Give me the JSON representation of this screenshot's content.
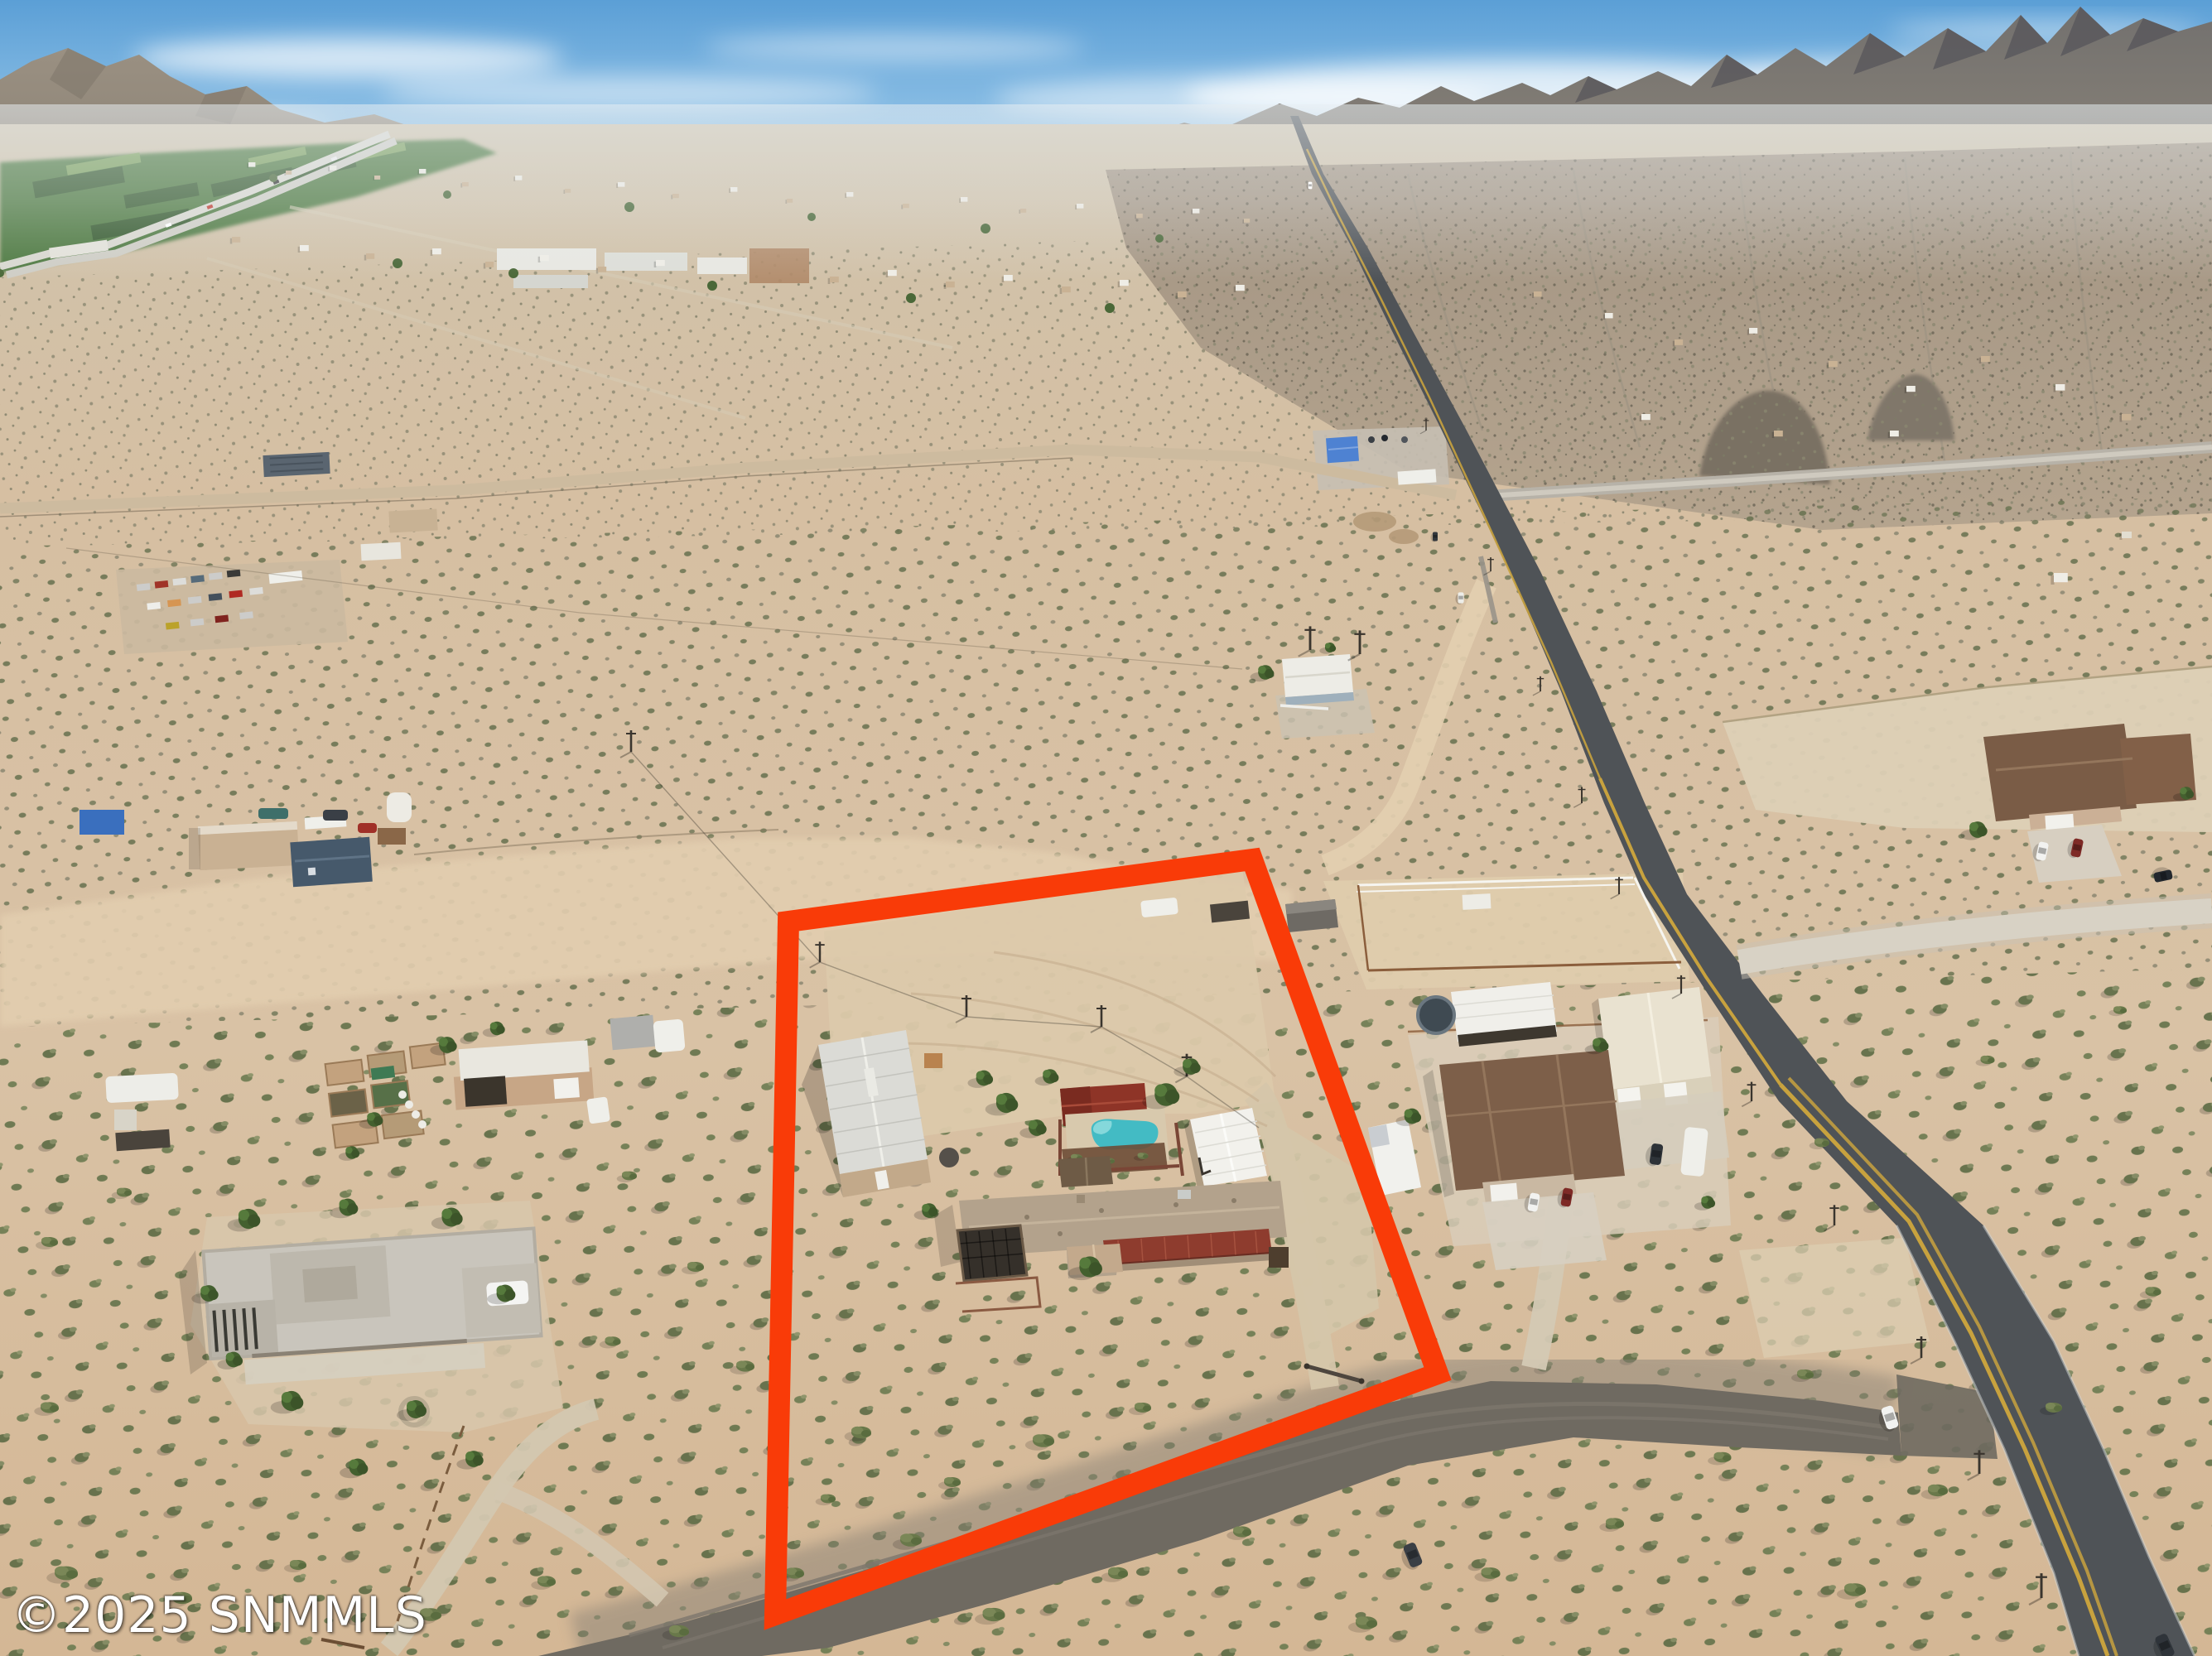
{
  "watermark": {
    "text": "©2025 SNMMLS"
  },
  "colors": {
    "parcel_outline": "#F93B08",
    "sky_top": "#5B9FD6",
    "sky_mid": "#8FC1E6",
    "sky_horizon": "#D8E6EE",
    "sand_light": "#E3CEB2",
    "sand": "#D8C1A4",
    "sand_deep": "#D3B797",
    "scrub_dark": "#5C6B44",
    "scrub_mid": "#75815A",
    "mountain_left": "#948A7C",
    "mountain_right": "#6E6D6E",
    "mountain_shadow": "#565458",
    "farmland_green": "#4F7A42",
    "paved_road": "#4F5357",
    "road_yellow": "#C8A23E",
    "gravel_dark": "#6F6A61",
    "gravel_light": "#D7CFC0",
    "pool_water": "#43BBC4",
    "roof_red": "#8E3427",
    "roof_brown": "#7D5F49",
    "roof_white": "#F2F1EC",
    "roof_cream": "#E9E2D0",
    "adobe_tan": "#C7A686",
    "house_blue": "#4E82D2"
  },
  "scene": {
    "type": "aerial-real-estate-photo",
    "parcel_outline_points": "952,1113 1512,1038 1736,1659 936,1950",
    "features": [
      "red outlined subject parcel with main house, red metal porch roof, white metal garage, red-roof pool cabana, kidney-shaped swimming pool, large metal workshop, dirt yard and gated gravel driveway",
      "desert valley town with distant mountains, green farmland and highway at upper left",
      "jagged mountain range across upper right",
      "paved two-lane road with double yellow line curving down the right side",
      "dark gravel road along the parcel's south boundary meeting the paved road at a junction with a white car",
      "neighboring horse property with corral, cream metal barn, brown-roof house, trampoline and RV to the east",
      "large flat-roof southwestern home with curved driveway to the southwest",
      "small homesteads, garden beds, trailers and a vehicle boneyard to the west"
    ]
  }
}
